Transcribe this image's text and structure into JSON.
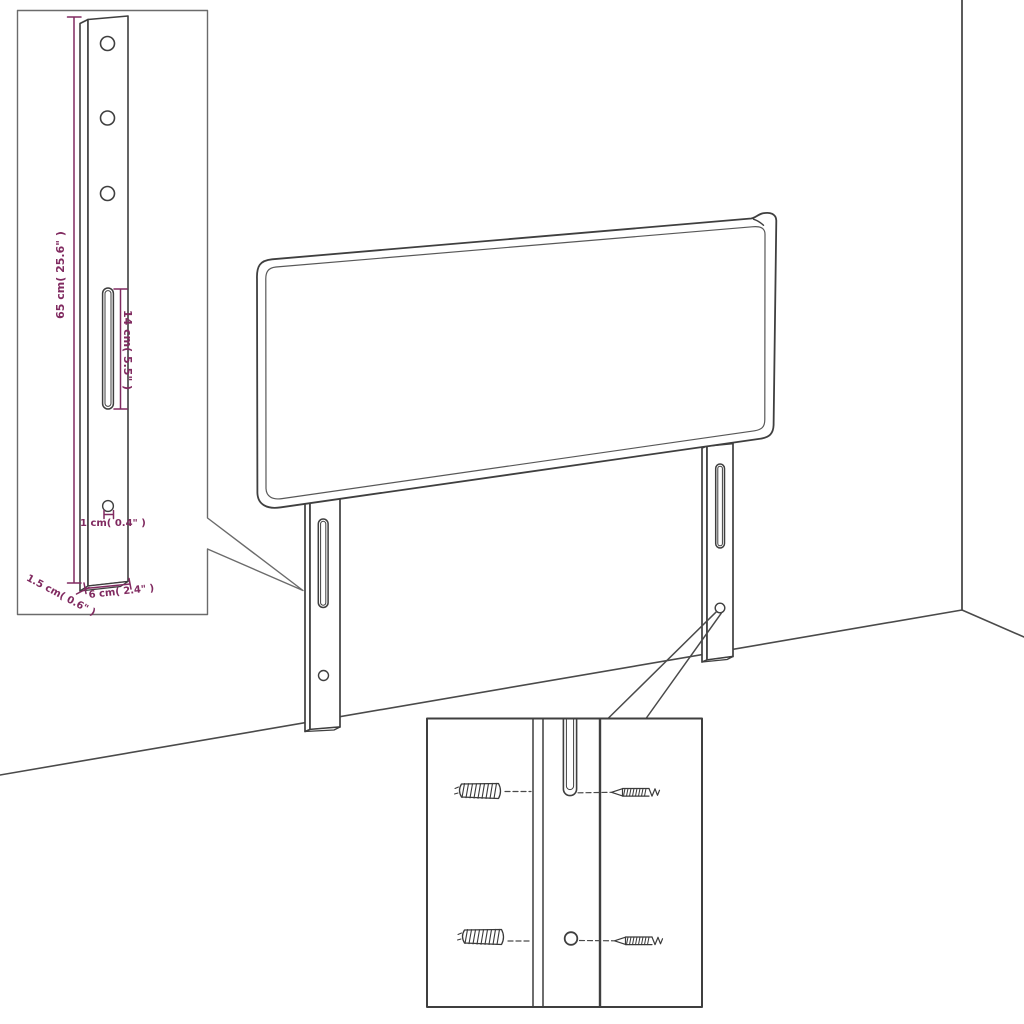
{
  "diagram_type": "furniture-headboard-assembly-dimensions",
  "labels": {
    "leg_height": "65 cm( 25.6\" )",
    "slot_length": "14 cm( 5.5\" )",
    "hole_diameter": "1 cm( 0.4\" )",
    "side_thickness": "1.5 cm( 0.6\" )",
    "leg_width": "6 cm( 2.4\" )"
  },
  "colors": {
    "dimension": "#802a60",
    "line": "#3f3f3f",
    "background": "#ffffff"
  }
}
